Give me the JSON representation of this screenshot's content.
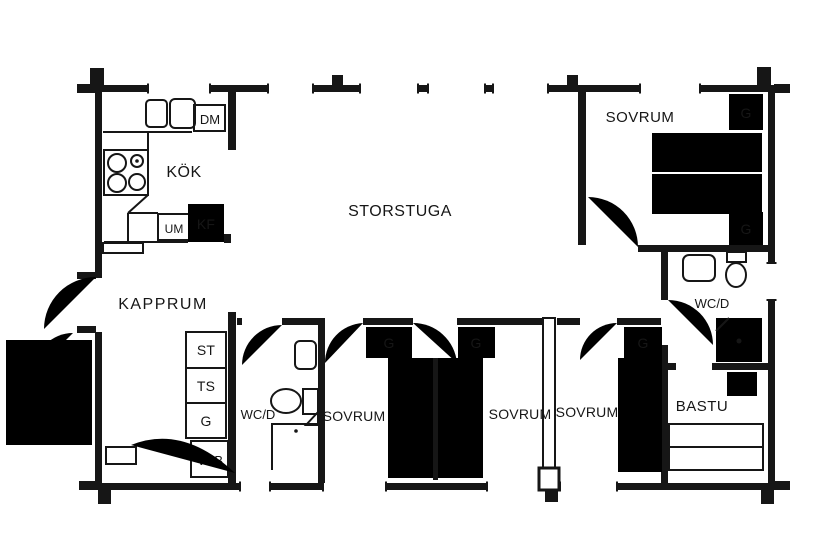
{
  "document": {
    "type": "floor-plan",
    "style": "scanned log-house blueprint"
  },
  "colors": {
    "line": "#161616",
    "background": "#ffffff"
  },
  "rooms": {
    "kitchen": {
      "label": "KÖK"
    },
    "living_room": {
      "label": "STORSTUGA"
    },
    "bedroom_ne": {
      "label": "SOVRUM"
    },
    "wc_shower_right": {
      "label": "WC/D"
    },
    "sauna": {
      "label": "BASTU"
    },
    "cloakroom": {
      "label": "KAPPRUM"
    },
    "wc_shower_left": {
      "label": "WC/D"
    },
    "bedroom_s1": {
      "label": "SOVRUM"
    },
    "bedroom_s2": {
      "label": "SOVRUM"
    },
    "bedroom_s3": {
      "label": "SOVRUM"
    }
  },
  "fixtures": {
    "dishwasher": {
      "label": "DM"
    },
    "fridge_freezer": {
      "label": "KF"
    },
    "oven_microwave": {
      "label": "UM"
    },
    "water_heater": {
      "label": "VVB"
    },
    "cleaning_closet": {
      "label": "ST"
    },
    "drying_closet": {
      "label": "TS"
    },
    "wardrobe": {
      "label": "G"
    }
  }
}
